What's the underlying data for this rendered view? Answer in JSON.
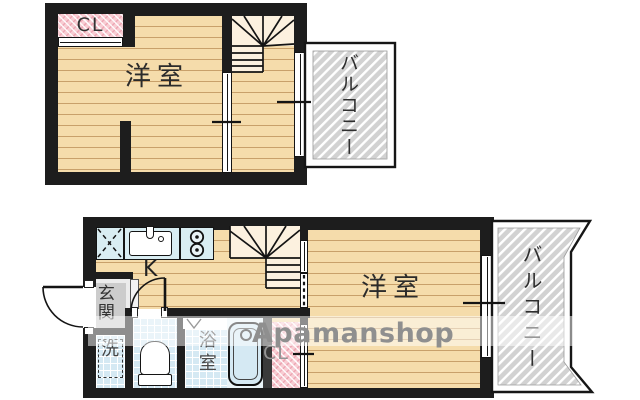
{
  "colors": {
    "wall": "#1d1d1d",
    "floor": "#f5dcab",
    "floor_line": "#c8a06a",
    "stair_bg": "#fcf1df",
    "closet_pink": "#f8cdd3",
    "closet_hatch": "#eda7b4",
    "balcony_gray": "#d2d2d2",
    "counter_blue": "#d9edf2",
    "tile_blue": "#d5e9f3",
    "entrance_gray": "#cccccc",
    "label_dark": "#2b2b2b",
    "watermark_gray": "#8f8f8f"
  },
  "upper_floor": {
    "closet_label": "CL",
    "room_label": "洋室",
    "balcony_label": "バルコニー"
  },
  "lower_floor": {
    "kitchen_label": "K",
    "entrance_label": "玄関",
    "laundry_label": "洗",
    "bath_label": "浴室",
    "room_label": "洋室",
    "closet_label": "CL",
    "balcony_label": "バルコニー"
  },
  "watermark": {
    "text": "Apamanshop"
  }
}
